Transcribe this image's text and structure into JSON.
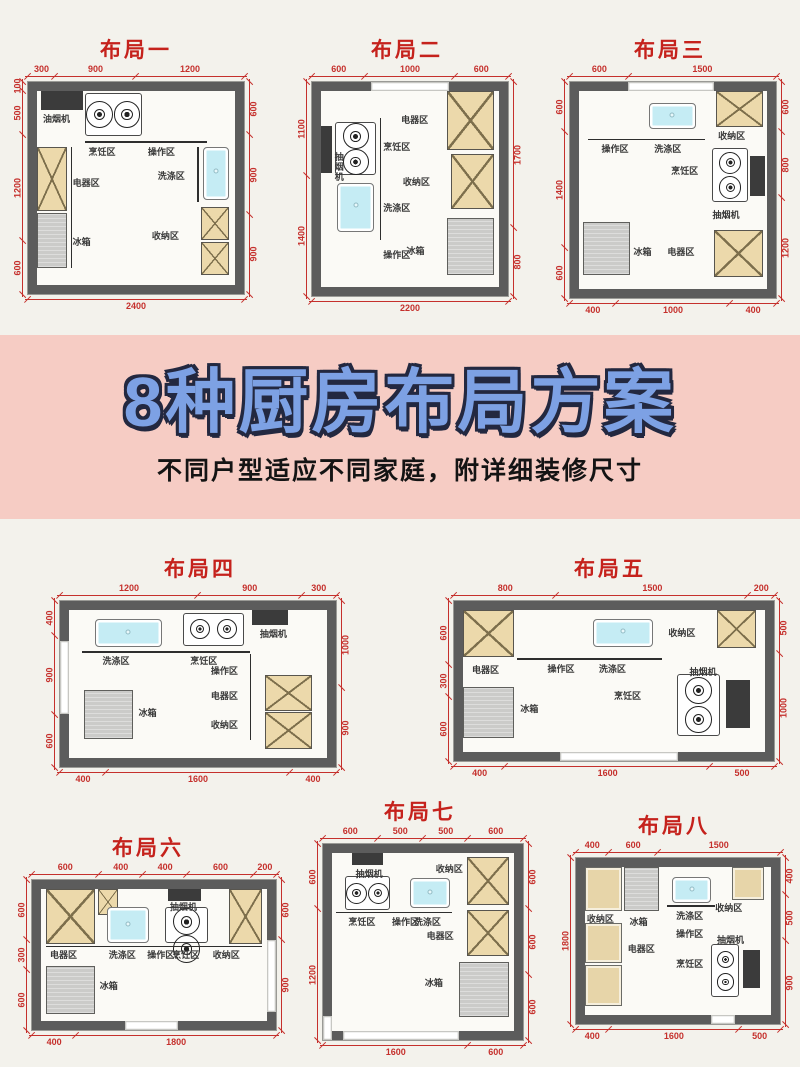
{
  "banner": {
    "title": "8种厨房布局方案",
    "subtitle": "不同户型适应不同家庭，附详细装修尺寸",
    "bg_color": "#f6ccc4",
    "title_color": "#7da1e4",
    "outline_color": "#232840"
  },
  "colors": {
    "page_bg": "#f3f2ec",
    "wall": "#5c5c5c",
    "dimension_red": "#c5302c",
    "cabinet_tan": "#ecd9ab",
    "fridge_gray": "#cbcbc9",
    "sink_cyan": "#c5ecf4",
    "hood_dark": "#3b3b3b",
    "title_red": "#c5221c"
  },
  "legend": {
    "zone_terms": [
      "烹饪区",
      "操作区",
      "洗涤区",
      "电器区",
      "收纳区",
      "冰箱",
      "油烟机",
      "抽烟机"
    ]
  },
  "layouts": [
    {
      "title": "布局一",
      "box": [
        0,
        18,
        272,
        312
      ],
      "plan": [
        28,
        64,
        216,
        212
      ],
      "dims": {
        "top": [
          "300",
          "900",
          "1200"
        ],
        "bottom": [
          "2400"
        ],
        "left": [
          "100",
          "500",
          "1200",
          "600"
        ],
        "right": [
          "600",
          "900",
          "900"
        ]
      },
      "gaps": [],
      "elements": [
        {
          "t": "hood",
          "x": 2,
          "y": 0,
          "w": 21,
          "h": 10
        },
        {
          "t": "stove",
          "x": 24,
          "y": 1,
          "w": 29,
          "h": 22
        },
        {
          "t": "lineh",
          "x": 24,
          "y": 26,
          "w": 62
        },
        {
          "t": "linev",
          "x": 17,
          "y": 29,
          "h": 62
        },
        {
          "t": "sink",
          "x": 84,
          "y": 29,
          "w": 13,
          "h": 27
        },
        {
          "t": "linev",
          "x": 81,
          "y": 29,
          "h": 28
        },
        {
          "t": "cab",
          "x": 0,
          "y": 29,
          "w": 15,
          "h": 33
        },
        {
          "t": "fridge",
          "x": 0,
          "y": 63,
          "w": 15,
          "h": 28
        },
        {
          "t": "cab",
          "x": 83,
          "y": 60,
          "w": 14,
          "h": 17
        },
        {
          "t": "cab",
          "x": 83,
          "y": 78,
          "w": 14,
          "h": 17
        }
      ],
      "labels": [
        {
          "text": "油烟机",
          "x": 3,
          "y": 12
        },
        {
          "text": "烹饪区",
          "x": 26,
          "y": 29
        },
        {
          "text": "操作区",
          "x": 56,
          "y": 29
        },
        {
          "text": "洗涤区",
          "x": 61,
          "y": 41
        },
        {
          "text": "电器区",
          "x": 18,
          "y": 45
        },
        {
          "text": "冰箱",
          "x": 18,
          "y": 75
        },
        {
          "text": "收纳区",
          "x": 58,
          "y": 72
        }
      ]
    },
    {
      "title": "布局二",
      "box": [
        278,
        18,
        258,
        312
      ],
      "plan": [
        34,
        64,
        196,
        214
      ],
      "dims": {
        "top": [
          "600",
          "1000",
          "600"
        ],
        "bottom": [
          "2200"
        ],
        "left": [
          "1100",
          "1400"
        ],
        "right": [
          "1700",
          "800"
        ]
      },
      "gaps": [
        {
          "side": "top",
          "start": 30,
          "len": 40
        }
      ],
      "elements": [
        {
          "t": "hood",
          "x": 0,
          "y": 18,
          "w": 6,
          "h": 24
        },
        {
          "t": "stove",
          "x": 8,
          "y": 16,
          "w": 23,
          "h": 27
        },
        {
          "t": "linev",
          "x": 33,
          "y": 14,
          "h": 62
        },
        {
          "t": "sink",
          "x": 9,
          "y": 47,
          "w": 21,
          "h": 25
        },
        {
          "t": "cab",
          "x": 71,
          "y": 0,
          "w": 26,
          "h": 30
        },
        {
          "t": "cab",
          "x": 73,
          "y": 32,
          "w": 24,
          "h": 28
        },
        {
          "t": "fridge",
          "x": 71,
          "y": 65,
          "w": 26,
          "h": 29
        }
      ],
      "labels": [
        {
          "text": "抽烟机",
          "x": 7,
          "y": 31,
          "v": true
        },
        {
          "text": "烹饪区",
          "x": 35,
          "y": 26
        },
        {
          "text": "洗涤区",
          "x": 35,
          "y": 57
        },
        {
          "text": "操作区",
          "x": 35,
          "y": 81
        },
        {
          "text": "电器区",
          "x": 45,
          "y": 12
        },
        {
          "text": "收纳区",
          "x": 46,
          "y": 44
        },
        {
          "text": "冰箱",
          "x": 48,
          "y": 79
        }
      ]
    },
    {
      "title": "布局三",
      "box": [
        540,
        18,
        260,
        312
      ],
      "plan": [
        30,
        64,
        206,
        216
      ],
      "dims": {
        "top": [
          "600",
          "1500"
        ],
        "bottom": [
          "400",
          "1000",
          "400"
        ],
        "left": [
          "600",
          "1400",
          "600"
        ],
        "right": [
          "600",
          "800",
          "1200"
        ]
      },
      "gaps": [
        {
          "side": "top",
          "start": 28,
          "len": 42
        }
      ],
      "elements": [
        {
          "t": "sink",
          "x": 37,
          "y": 6,
          "w": 25,
          "h": 13
        },
        {
          "t": "lineh",
          "x": 5,
          "y": 24,
          "w": 62
        },
        {
          "t": "cab",
          "x": 73,
          "y": 0,
          "w": 25,
          "h": 18
        },
        {
          "t": "stove",
          "x": 71,
          "y": 29,
          "w": 19,
          "h": 27
        },
        {
          "t": "hood",
          "x": 91,
          "y": 33,
          "w": 8,
          "h": 20
        },
        {
          "t": "fridge",
          "x": 2,
          "y": 66,
          "w": 25,
          "h": 27
        },
        {
          "t": "cab",
          "x": 72,
          "y": 70,
          "w": 26,
          "h": 24
        }
      ],
      "labels": [
        {
          "text": "操作区",
          "x": 12,
          "y": 27
        },
        {
          "text": "洗涤区",
          "x": 40,
          "y": 27
        },
        {
          "text": "收纳区",
          "x": 74,
          "y": 20
        },
        {
          "text": "烹饪区",
          "x": 49,
          "y": 38
        },
        {
          "text": "抽烟机",
          "x": 71,
          "y": 60
        },
        {
          "text": "冰箱",
          "x": 29,
          "y": 79
        },
        {
          "text": "电器区",
          "x": 47,
          "y": 79
        }
      ]
    },
    {
      "title": "布局四",
      "box": [
        30,
        545,
        340,
        250
      ],
      "plan": [
        30,
        56,
        276,
        166
      ],
      "dims": {
        "top": [
          "1200",
          "900",
          "300"
        ],
        "bottom": [
          "400",
          "1600",
          "400"
        ],
        "left": [
          "400",
          "900",
          "600"
        ],
        "right": [
          "1000",
          "900"
        ]
      },
      "gaps": [
        {
          "side": "left",
          "start": 24,
          "len": 44
        }
      ],
      "elements": [
        {
          "t": "sink",
          "x": 10,
          "y": 6,
          "w": 26,
          "h": 19
        },
        {
          "t": "stove",
          "x": 44,
          "y": 2,
          "w": 24,
          "h": 22
        },
        {
          "t": "hood",
          "x": 71,
          "y": 0,
          "w": 14,
          "h": 10
        },
        {
          "t": "lineh",
          "x": 5,
          "y": 28,
          "w": 65
        },
        {
          "t": "linev",
          "x": 70,
          "y": 30,
          "h": 58
        },
        {
          "t": "cab",
          "x": 76,
          "y": 44,
          "w": 18,
          "h": 24
        },
        {
          "t": "cab",
          "x": 76,
          "y": 69,
          "w": 18,
          "h": 25
        },
        {
          "t": "fridge",
          "x": 6,
          "y": 54,
          "w": 19,
          "h": 33
        }
      ],
      "labels": [
        {
          "text": "洗涤区",
          "x": 13,
          "y": 31
        },
        {
          "text": "烹饪区",
          "x": 47,
          "y": 31
        },
        {
          "text": "抽烟机",
          "x": 74,
          "y": 13
        },
        {
          "text": "操作区",
          "x": 55,
          "y": 38
        },
        {
          "text": "电器区",
          "x": 55,
          "y": 55
        },
        {
          "text": "收纳区",
          "x": 55,
          "y": 74
        },
        {
          "text": "冰箱",
          "x": 27,
          "y": 66
        }
      ]
    },
    {
      "title": "布局五",
      "box": [
        420,
        545,
        380,
        244
      ],
      "plan": [
        34,
        56,
        320,
        160
      ],
      "dims": {
        "top": [
          "800",
          "1500",
          "200"
        ],
        "bottom": [
          "400",
          "1600",
          "500"
        ],
        "left": [
          "600",
          "300",
          "600"
        ],
        "right": [
          "500",
          "1000"
        ]
      },
      "gaps": [
        {
          "side": "bottom",
          "start": 33,
          "len": 37
        }
      ],
      "elements": [
        {
          "t": "cab",
          "x": 0,
          "y": 0,
          "w": 17,
          "h": 33
        },
        {
          "t": "sink",
          "x": 43,
          "y": 6,
          "w": 20,
          "h": 20
        },
        {
          "t": "lineh",
          "x": 18,
          "y": 34,
          "w": 48
        },
        {
          "t": "cab",
          "x": 84,
          "y": 0,
          "w": 13,
          "h": 27
        },
        {
          "t": "stove",
          "x": 71,
          "y": 45,
          "w": 14,
          "h": 44
        },
        {
          "t": "hood",
          "x": 87,
          "y": 49,
          "w": 8,
          "h": 34
        },
        {
          "t": "fridge",
          "x": 0,
          "y": 54,
          "w": 17,
          "h": 36
        }
      ],
      "labels": [
        {
          "text": "电器区",
          "x": 3,
          "y": 39
        },
        {
          "text": "操作区",
          "x": 28,
          "y": 38
        },
        {
          "text": "洗涤区",
          "x": 45,
          "y": 38
        },
        {
          "text": "收纳区",
          "x": 68,
          "y": 13
        },
        {
          "text": "抽烟机",
          "x": 75,
          "y": 40
        },
        {
          "text": "烹饪区",
          "x": 50,
          "y": 57
        },
        {
          "text": "冰箱",
          "x": 19,
          "y": 66
        }
      ]
    },
    {
      "title": "布局六",
      "box": [
        0,
        812,
        296,
        252
      ],
      "plan": [
        32,
        68,
        244,
        150
      ],
      "dims": {
        "top": [
          "600",
          "400",
          "400",
          "600",
          "200"
        ],
        "bottom": [
          "400",
          "1800"
        ],
        "left": [
          "600",
          "300",
          "600"
        ],
        "right": [
          "600",
          "900"
        ]
      },
      "gaps": [
        {
          "side": "bottom",
          "start": 38,
          "len": 22
        },
        {
          "side": "right",
          "start": 40,
          "len": 48
        }
      ],
      "elements": [
        {
          "t": "cab",
          "x": 2,
          "y": 0,
          "w": 22,
          "h": 42
        },
        {
          "t": "cab",
          "x": 25,
          "y": 0,
          "w": 9,
          "h": 20
        },
        {
          "t": "sink",
          "x": 29,
          "y": 14,
          "w": 19,
          "h": 27
        },
        {
          "t": "hood",
          "x": 56,
          "y": 0,
          "w": 15,
          "h": 9
        },
        {
          "t": "stove",
          "x": 55,
          "y": 14,
          "w": 19,
          "h": 27
        },
        {
          "t": "cab",
          "x": 83,
          "y": 0,
          "w": 15,
          "h": 42
        },
        {
          "t": "lineh",
          "x": 2,
          "y": 43,
          "w": 96
        },
        {
          "t": "fridge",
          "x": 2,
          "y": 58,
          "w": 22,
          "h": 37
        }
      ],
      "labels": [
        {
          "text": "电器区",
          "x": 4,
          "y": 46
        },
        {
          "text": "洗涤区",
          "x": 30,
          "y": 46
        },
        {
          "text": "操作区",
          "x": 47,
          "y": 46
        },
        {
          "text": "烹饪区",
          "x": 58,
          "y": 46
        },
        {
          "text": "收纳区",
          "x": 76,
          "y": 46
        },
        {
          "text": "冰箱",
          "x": 26,
          "y": 70
        },
        {
          "text": "抽烟机",
          "x": 57,
          "y": 10
        }
      ]
    },
    {
      "title": "布局七",
      "box": [
        295,
        790,
        250,
        277
      ],
      "plan": [
        28,
        54,
        200,
        196
      ],
      "dims": {
        "top": [
          "600",
          "500",
          "500",
          "600"
        ],
        "bottom": [
          "1600",
          "600"
        ],
        "left": [
          "600",
          "1200"
        ],
        "right": [
          "600",
          "600",
          "600"
        ]
      },
      "gaps": [
        {
          "side": "bottom",
          "start": 10,
          "len": 58
        },
        {
          "side": "left",
          "start": 88,
          "len": 12
        }
      ],
      "elements": [
        {
          "t": "hood",
          "x": 11,
          "y": 0,
          "w": 17,
          "h": 7
        },
        {
          "t": "stove",
          "x": 7,
          "y": 13,
          "w": 25,
          "h": 19
        },
        {
          "t": "sink",
          "x": 43,
          "y": 14,
          "w": 22,
          "h": 17
        },
        {
          "t": "lineh",
          "x": 2,
          "y": 33,
          "w": 64
        },
        {
          "t": "cab",
          "x": 74,
          "y": 2,
          "w": 23,
          "h": 27
        },
        {
          "t": "cab",
          "x": 74,
          "y": 32,
          "w": 23,
          "h": 26
        },
        {
          "t": "fridge",
          "x": 70,
          "y": 61,
          "w": 27,
          "h": 31
        }
      ],
      "labels": [
        {
          "text": "抽烟机",
          "x": 13,
          "y": 9
        },
        {
          "text": "烹饪区",
          "x": 9,
          "y": 36
        },
        {
          "text": "操作区",
          "x": 33,
          "y": 36
        },
        {
          "text": "洗涤区",
          "x": 45,
          "y": 36
        },
        {
          "text": "收纳区",
          "x": 57,
          "y": 6
        },
        {
          "text": "电器区",
          "x": 52,
          "y": 44
        },
        {
          "text": "冰箱",
          "x": 51,
          "y": 70
        }
      ]
    },
    {
      "title": "布局八",
      "box": [
        548,
        798,
        252,
        264
      ],
      "plan": [
        28,
        60,
        204,
        166
      ],
      "dims": {
        "top": [
          "400",
          "600",
          "1500"
        ],
        "bottom": [
          "400",
          "1600",
          "500"
        ],
        "left": [
          "1800"
        ],
        "right": [
          "400",
          "500",
          "900"
        ]
      },
      "gaps": [
        {
          "side": "bottom",
          "start": 66,
          "len": 12
        }
      ],
      "elements": [
        {
          "t": "cabp",
          "x": 0,
          "y": 0,
          "w": 20,
          "h": 30
        },
        {
          "t": "fridge",
          "x": 21,
          "y": 0,
          "w": 19,
          "h": 30
        },
        {
          "t": "sink",
          "x": 47,
          "y": 7,
          "w": 21,
          "h": 17
        },
        {
          "t": "cabp",
          "x": 79,
          "y": 0,
          "w": 17,
          "h": 22
        },
        {
          "t": "cabp",
          "x": 0,
          "y": 38,
          "w": 20,
          "h": 27
        },
        {
          "t": "cabp",
          "x": 0,
          "y": 66,
          "w": 20,
          "h": 28
        },
        {
          "t": "lineh",
          "x": 44,
          "y": 26,
          "w": 26
        },
        {
          "t": "stove",
          "x": 68,
          "y": 52,
          "w": 15,
          "h": 36
        },
        {
          "t": "hood",
          "x": 85,
          "y": 56,
          "w": 9,
          "h": 26
        }
      ],
      "labels": [
        {
          "text": "收纳区",
          "x": 1,
          "y": 32
        },
        {
          "text": "冰箱",
          "x": 24,
          "y": 34
        },
        {
          "text": "洗涤区",
          "x": 49,
          "y": 30
        },
        {
          "text": "收纳区",
          "x": 70,
          "y": 24
        },
        {
          "text": "电器区",
          "x": 23,
          "y": 52
        },
        {
          "text": "操作区",
          "x": 49,
          "y": 42
        },
        {
          "text": "烹饪区",
          "x": 49,
          "y": 62
        },
        {
          "text": "抽烟机",
          "x": 71,
          "y": 46
        }
      ]
    }
  ]
}
